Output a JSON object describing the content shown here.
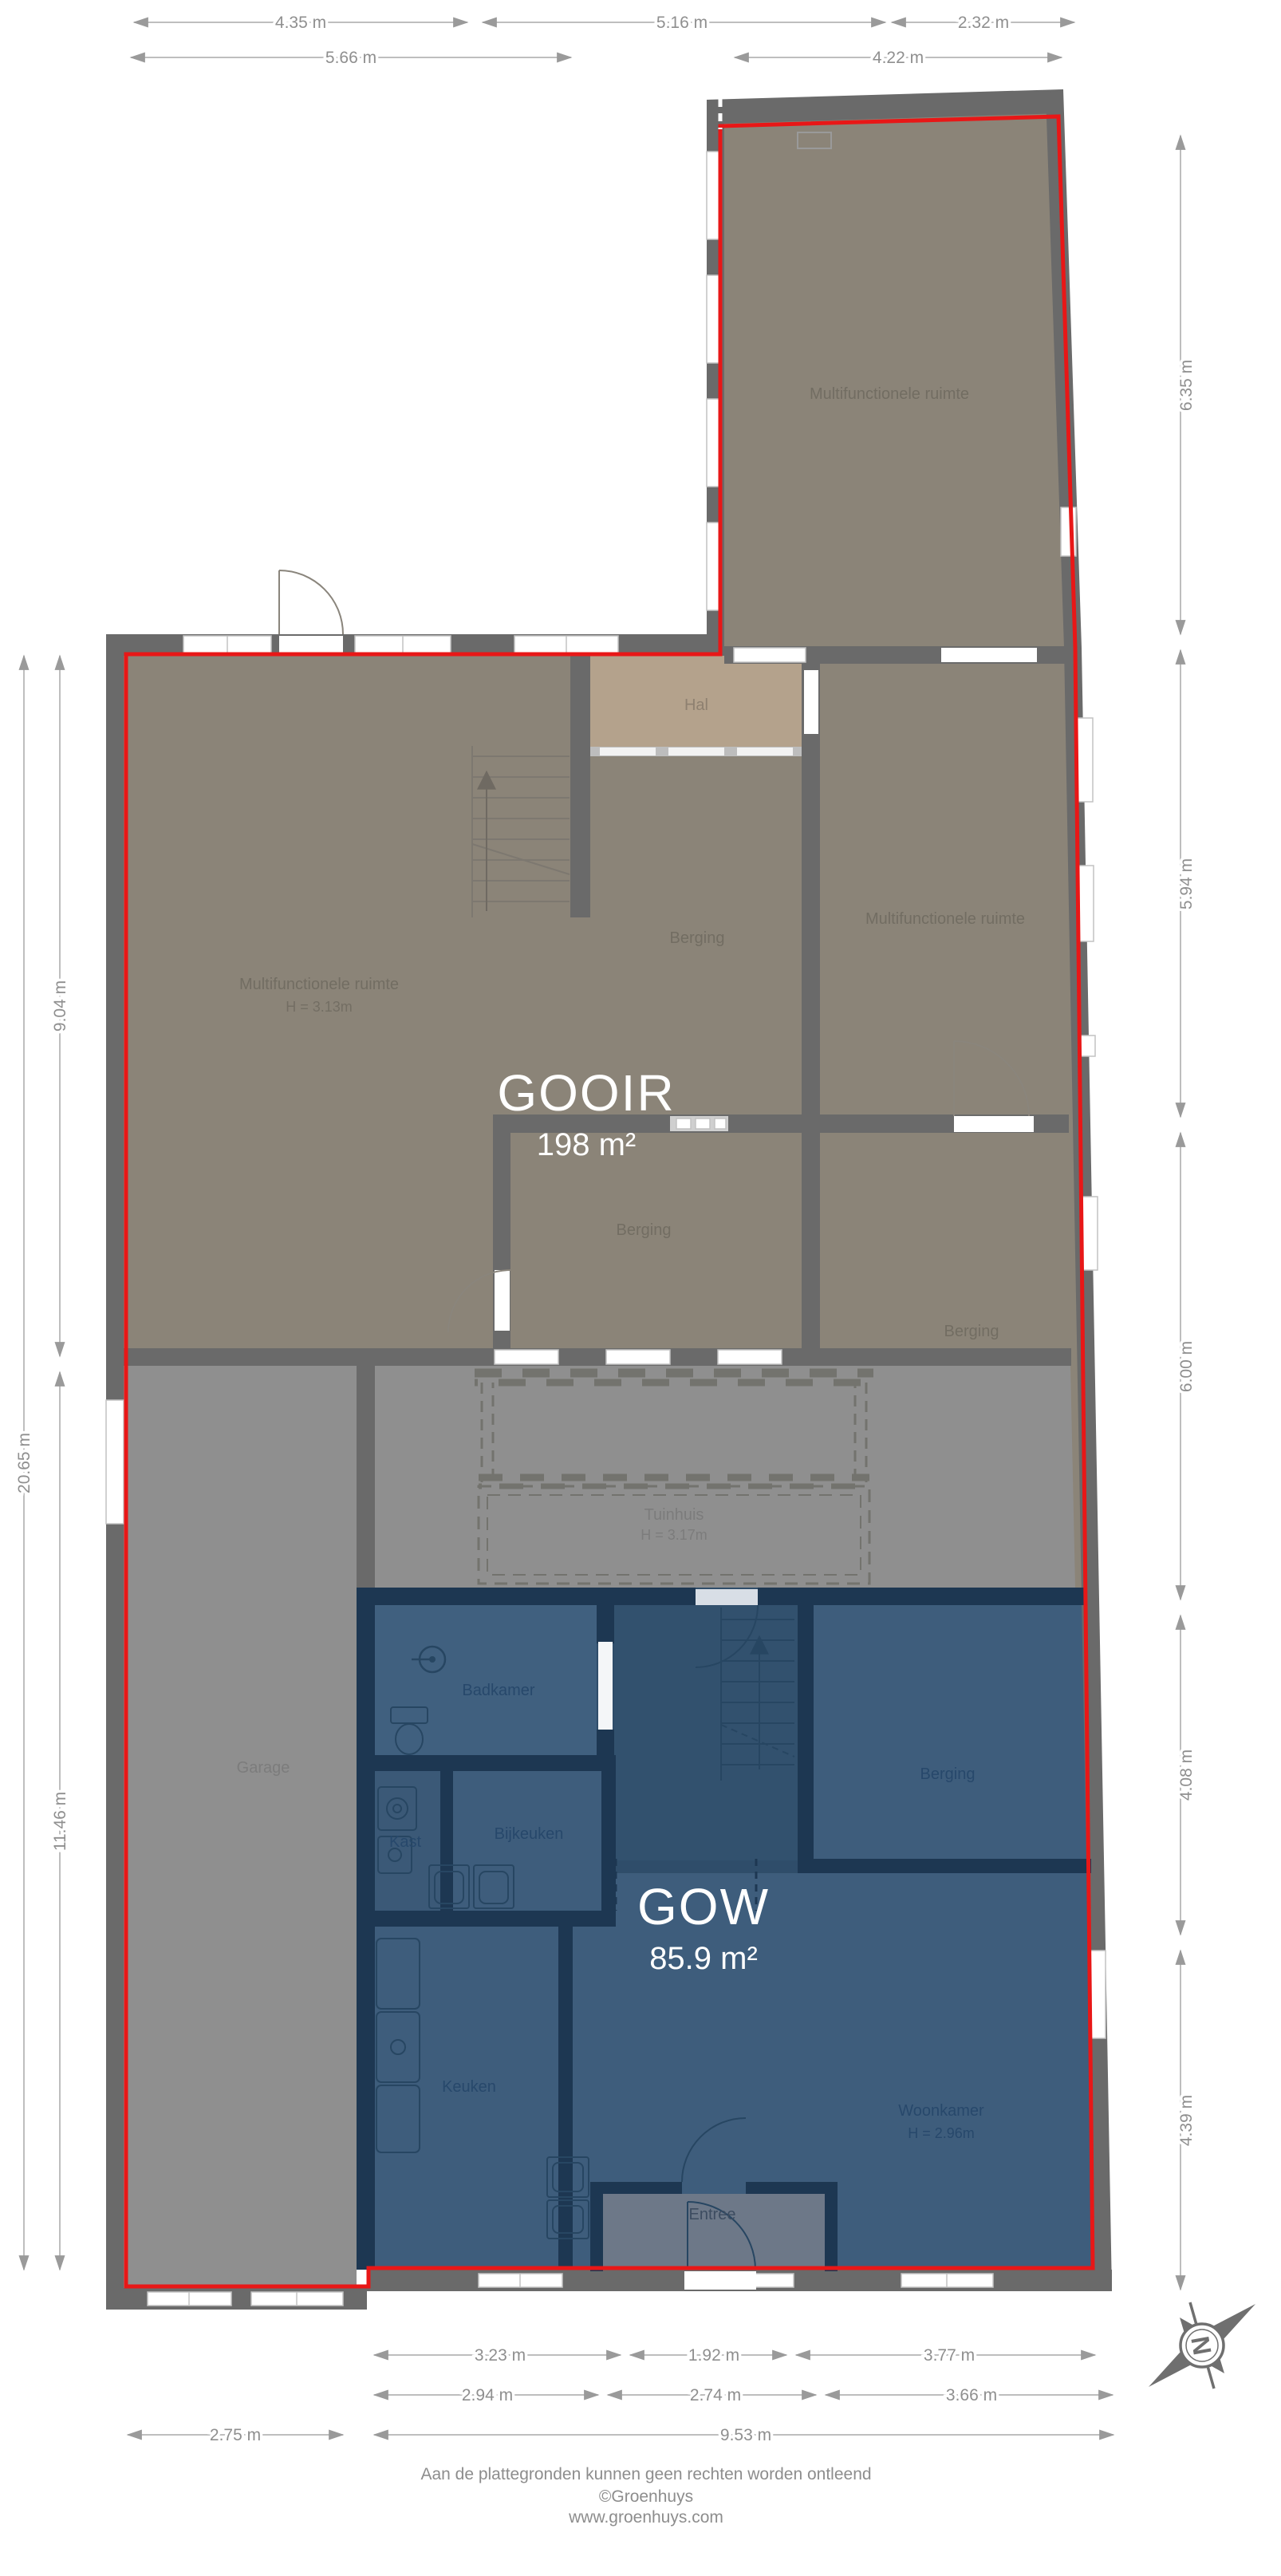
{
  "sections": {
    "gooir": {
      "name": "GOOIR",
      "area": "198 m²"
    },
    "gow": {
      "name": "GOW",
      "area": "85.9 m²"
    }
  },
  "rooms": {
    "multi_top": "Multifunctionele ruimte",
    "multi_right": "Multifunctionele ruimte",
    "multi_left": "Multifunctionele ruimte",
    "multi_left_height": "H = 3.13m",
    "hal": "Hal",
    "berging_center": "Berging",
    "berging_mid": "Berging",
    "berging_right": "Berging",
    "berging_gow": "Berging",
    "tuinhuis": "Tuinhuis",
    "tuinhuis_height": "H = 3.17m",
    "garage": "Garage",
    "badkamer": "Badkamer",
    "kast": "Kast",
    "bijkeuken": "Bijkeuken",
    "keuken": "Keuken",
    "woonkamer": "Woonkamer",
    "woonkamer_height": "H = 2.96m",
    "entree": "Entree"
  },
  "dims": {
    "t1a": "4.35 m",
    "t1b": "5.16 m",
    "t1c": "2.32 m",
    "t2a": "5.66 m",
    "t2b": "4.22 m",
    "r1": "6.35 m",
    "r2": "5.94 m",
    "r3": "6.00 m",
    "r4": "4.08 m",
    "r5": "4.39 m",
    "l1": "9.04 m",
    "l2": "20.65 m",
    "l3": "11.46 m",
    "b1a": "3.23 m",
    "b1b": "1.92 m",
    "b1c": "3.77 m",
    "b2a": "2.94 m",
    "b2b": "2.74 m",
    "b2c": "3.66 m",
    "b3a": "2.75 m",
    "b3b": "9.53 m"
  },
  "compass": {
    "label": "N"
  },
  "footer": {
    "disclaimer": "Aan de plattegronden kunnen geen rechten worden ontleend",
    "company": "©Groenhuys",
    "website": "www.groenhuys.com"
  },
  "colors": {
    "outline": "#e81717",
    "wall_gray": "#6a6a6a",
    "room_olive": "#8b8478",
    "neutral_gray": "#8f8f8f",
    "hal_tan": "#b4a28c",
    "wall_navy": "#1d3752",
    "room_blue": "#3e5d7c",
    "entree_gray": "#6d7888"
  }
}
